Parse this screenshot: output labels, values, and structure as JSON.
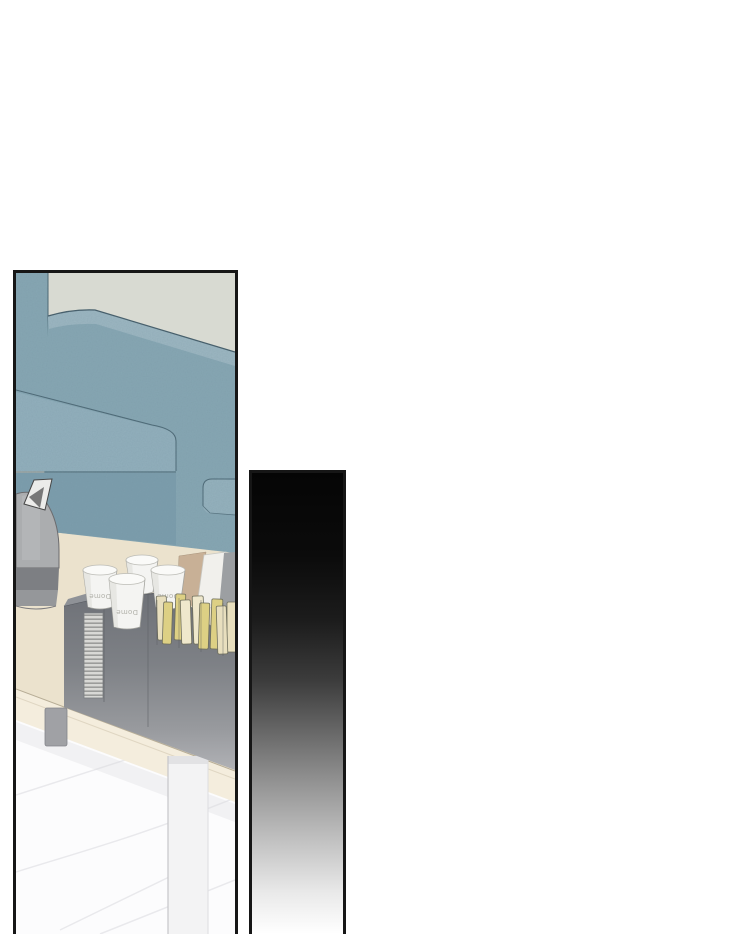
{
  "page": {
    "background_color": "#ffffff"
  },
  "left_panel": {
    "kind": "comic-illustration-panel",
    "border_color": "#161616",
    "scene": {
      "description": "teal fabric sofa beside a beige coffee table holding a grey kettle, stacked paper cups, grey cup dispensers and rows of sugar-stick packets, on a white marble floor",
      "wall_color": "#d8dad2",
      "sofa_color": "#87a7b4",
      "table_color": "#ebe2cd",
      "floor_color": "#fcfcfd",
      "kettle_color": "#abadaf",
      "dispenser_color": "#75787d",
      "packet_color": "#e5dbb4",
      "cup_count": 4,
      "cup_brand_text": "Dome"
    }
  },
  "right_panel": {
    "kind": "gradient-transition-panel",
    "border_color": "#161616",
    "gradient_top_color": "#050505",
    "gradient_bottom_color": "#ffffff"
  }
}
